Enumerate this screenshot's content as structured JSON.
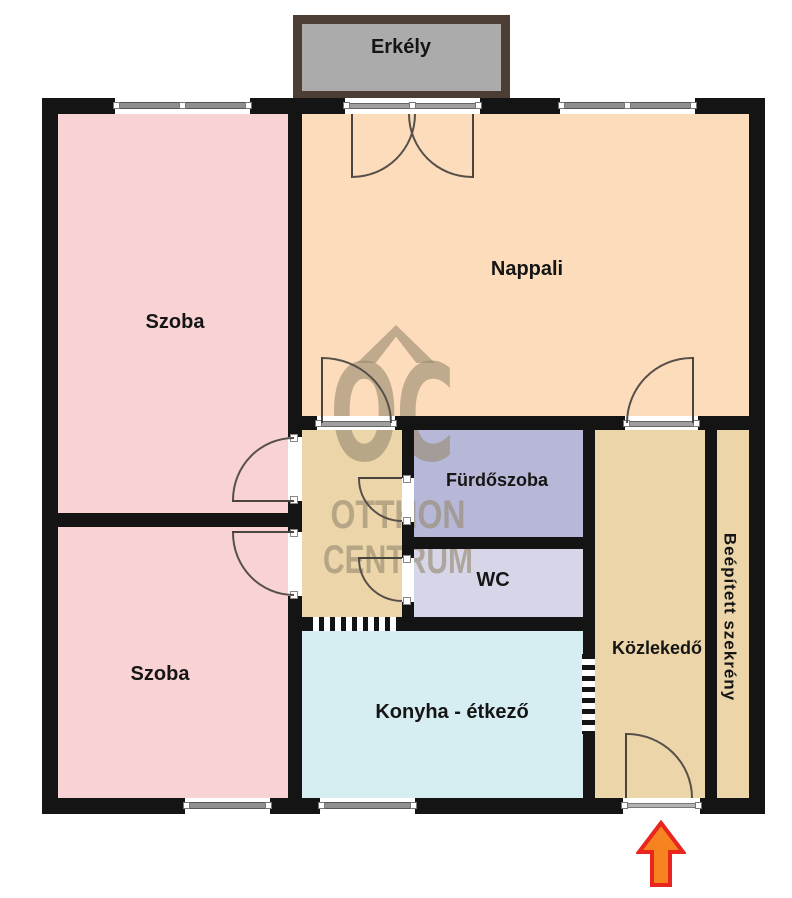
{
  "brand": {
    "logo_text": "OC",
    "line1": "OTTHON",
    "line2": "CENTRUM"
  },
  "rooms": {
    "erkely": "Erkély",
    "szoba_top": "Szoba",
    "nappali": "Nappali",
    "szoba_bottom": "Szoba",
    "furdoszoba": "Fürdőszoba",
    "wc": "WC",
    "konyha": "Konyha - étkező",
    "kozlekedo": "Közlekedő",
    "szekreny": "Beépített szekrény"
  },
  "colors": {
    "wall": "#141414",
    "room_pink": "#f9d3d3",
    "room_peach": "#fcdcbb",
    "hall_tan": "#ebd5a9",
    "kitchen_blue": "#d6edf2",
    "bathroom_purple": "#b7b8d7",
    "wc_lavender": "#d6d6e8",
    "balcony_gray": "#ababab",
    "balcony_border": "#4c3e35",
    "watermark_gray": "#96896f",
    "arrow_fill": "#f6831f",
    "arrow_stroke": "#e8251f"
  }
}
